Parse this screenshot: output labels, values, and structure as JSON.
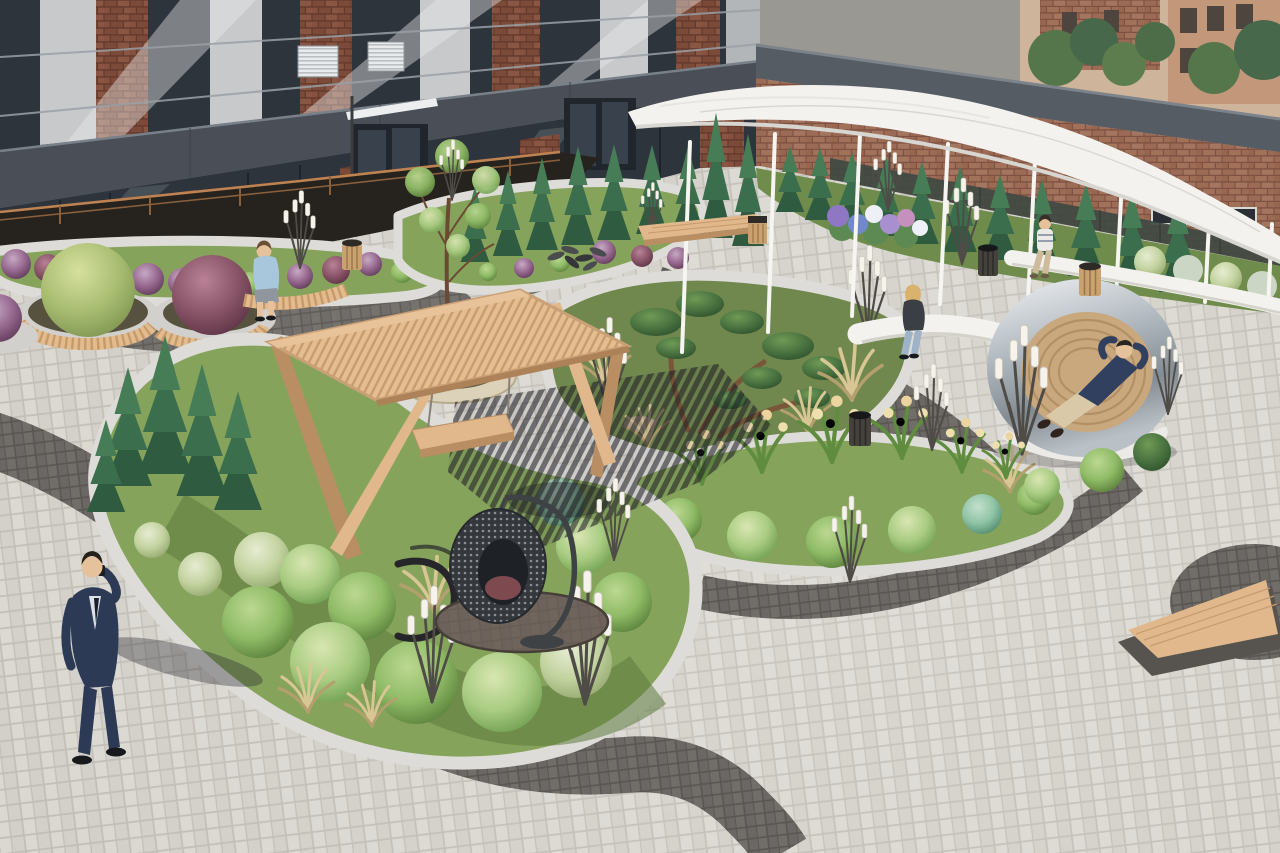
{
  "scene": {
    "type": "3d-architectural-visualization",
    "subject": "Aerial rendering of a modern residential courtyard with curvilinear planting beds, a white sculptural canopy, wooden pergola swing, hanging egg chair and a mirrored ring lounger",
    "time_of_day": "day",
    "people": [
      {
        "name": "man-walking-phone",
        "desc": "businessman in navy suit walking on pavers talking on phone"
      },
      {
        "name": "person-on-wood-bench",
        "desc": "person in light blue shirt sitting on curved wooden bench"
      },
      {
        "name": "woman-on-white-bench",
        "desc": "blonde woman sitting on white ribbon bench"
      },
      {
        "name": "woman-under-canopy",
        "desc": "woman seated on white bench beneath the canopy"
      },
      {
        "name": "man-in-ring-lounger",
        "desc": "man reclining inside mirrored ring lounge pod"
      }
    ],
    "objects": [
      "wooden pergola with hanging swing bench",
      "black wicker hanging egg chair",
      "mirror-ring lounge pod with wooden slat interior",
      "white curved canopy walkway on slim posts",
      "round stone tree planter",
      "oval concrete planters ringed with wooden benches",
      "white ribbon benches",
      "reed-shaped LED path lights",
      "wooden slatted litter bins",
      "triangular wooden bench on dark plinth",
      "dark clinker paver paths and circles",
      "copper handrail over dark rock mulch"
    ],
    "vegetation": [
      "clipped green shrub mounds",
      "columnar conifers and thujas",
      "niwaki cloud-pruned pines",
      "tan ornamental grasses",
      "daylilies with cream blooms",
      "hydrangeas in purple, blue, white and pink",
      "burgundy and purple globe shrubs"
    ],
    "architecture": [
      "brick and anthracite panel apartment building",
      "glazed ground floor with entrances",
      "single-storey brick wall wing with grey coping and green trellis",
      "background city houses and trees"
    ]
  },
  "colors": {
    "paving": "#dbd8d2",
    "paving2": "#d3d0c9",
    "pavingJoint": "#c2beb7",
    "pavingDark": "#6b6764",
    "pavingDarkJoint": "#595551",
    "gravel": "#dedcd8",
    "curbDark": "#7a7671",
    "lawn": "#86a35c",
    "moss": "#70874e",
    "foliageDark": "#2f5c40",
    "foliageMid": "#6f9e4f",
    "foliageLight": "#a9cc82",
    "teal": "#6ba888",
    "purple": "#96688f",
    "burgundy": "#7c4a5d",
    "grass": "#d8c494",
    "wood": "#e0b88c",
    "woodDark": "#b98e63",
    "concrete": "#d2d0cc",
    "stone": "#dcd2ba",
    "white": "#f3f2ef",
    "whiteShade": "#d5d2cb",
    "brick": "#7c4a39",
    "brickLight": "#9c6b55",
    "brickBg": "#c2977a",
    "panel": "#4a4f57",
    "coping": "#565c64",
    "glass": "#2e343b",
    "metal": "#b9bfc4",
    "rock": "#26231f",
    "railing": "#bf8352",
    "reedTip": "#f5f3ec",
    "reedStem": "#4f4c47",
    "navy": "#2c3a55",
    "denim": "#9fb3c8",
    "skin": "#e6c29c",
    "hairBlonde": "#d9b36c"
  }
}
